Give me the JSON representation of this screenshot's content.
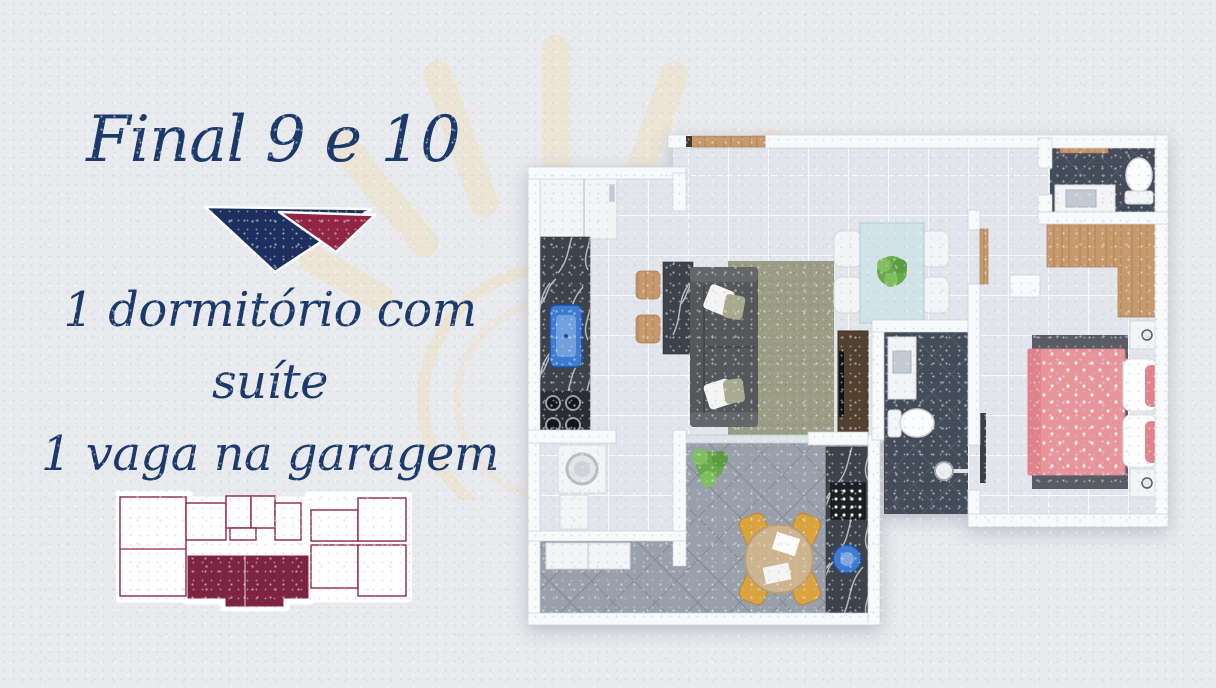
{
  "title": "Final 9 e 10",
  "features": {
    "line1": "1 dormitório com suíte",
    "line2": "1 vaga na garagem",
    "area": "51m²"
  },
  "palette": {
    "background": "#e9eaee",
    "text_navy": "#1b3a6b",
    "logo_navy": "#1c2f5f",
    "logo_maroon": "#932544",
    "keyplan_outline": "#8f2445",
    "keyplan_highlight": "#7d2442",
    "sun_watermark": "#efe2c0",
    "wall_white": "#f8f9fb",
    "floor_tile": "#e2e5ec",
    "balcony_tile": "#99a0ab",
    "bath_tile_dark": "#454c59",
    "counter_marble": "#3e434b",
    "wood": "#c69a6d",
    "bed_pink": "#e8949b",
    "rug_olive": "#9b9c84",
    "sofa_gray": "#55575b",
    "dining_table_blue": "#cfe3e9",
    "chair_yellow": "#daa33e",
    "sink_blue": "#3d7cd0",
    "plant_green": "#68a94b"
  }
}
